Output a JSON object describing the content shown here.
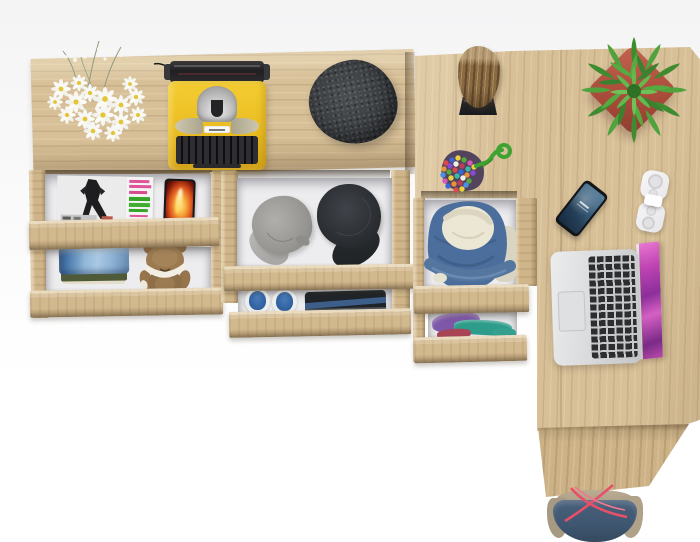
{
  "scene": {
    "title": "Top view of a light-oak corner desk with open drawers, decor and gadgets on a white background"
  },
  "palette": {
    "wood": "#d7bf97",
    "wood_shadow": "#b79a6e",
    "drawer_interior": "#ededef",
    "background": "#f4f4f5",
    "typewriter_yellow": "#eec32d",
    "pot_red": "#b2554a",
    "plant_green": "#4f9e3c",
    "denim_blue": "#4c6e9c",
    "screen_magenta": "#c044b4",
    "strap_red": "#e8506a"
  },
  "furniture": {
    "left_shelf": {
      "label": "Oak shelf desk top"
    },
    "right_desk": {
      "label": "Oak corner desk top"
    },
    "side_panel": {
      "label": "Oak desk side panel"
    },
    "drawer_units": [
      {
        "label": "Left drawer unit",
        "drawers": [
          "Magazines drawer",
          "Jeans and teddy drawer"
        ]
      },
      {
        "label": "Middle drawer unit",
        "drawers": [
          "Caps drawer",
          "Shoes drawer"
        ]
      },
      {
        "label": "Pedestal drawer unit",
        "drawers": [
          "Denim jacket drawer",
          "Folded shirts drawer"
        ]
      }
    ]
  },
  "items": {
    "flowers": {
      "label": "White daisy bouquet"
    },
    "typewriter": {
      "label": "Yellow vintage typewriter",
      "color": "#eec32d"
    },
    "beret": {
      "label": "Charcoal wool flat cap",
      "color": "#3a3d40"
    },
    "log": {
      "label": "Wooden log on black stand"
    },
    "pompom_bag": {
      "label": "Multicolour bead pouch with green cord"
    },
    "plant": {
      "label": "Green succulent in red square pot"
    },
    "phone": {
      "label": "Smartphone with blue lock screen"
    },
    "white_gadget": {
      "label": "White folded gadget"
    },
    "laptop": {
      "label": "Silver laptop with magenta wallpaper"
    },
    "magazine_bw": {
      "label": "Black-and-white fashion magazine"
    },
    "magazine_green": {
      "label": "Magazine with pink and green cover"
    },
    "fire_photo": {
      "label": "Phone showing flame photo"
    },
    "jeans": {
      "label": "Folded blue jeans"
    },
    "teddy": {
      "label": "Brown teddy bear"
    },
    "cap_gray": {
      "label": "Gray fabric cap"
    },
    "cap_black": {
      "label": "Black fabric cap"
    },
    "shoes": {
      "label": "Blue canvas shoes"
    },
    "dark_clothes": {
      "label": "Folded dark clothes"
    },
    "denim_jacket": {
      "label": "Denim jacket with fleece lining"
    },
    "folded_shirts": {
      "label": "Folded purple and teal shirts"
    },
    "tote_bag": {
      "label": "Denim tote bag with red straps"
    }
  }
}
